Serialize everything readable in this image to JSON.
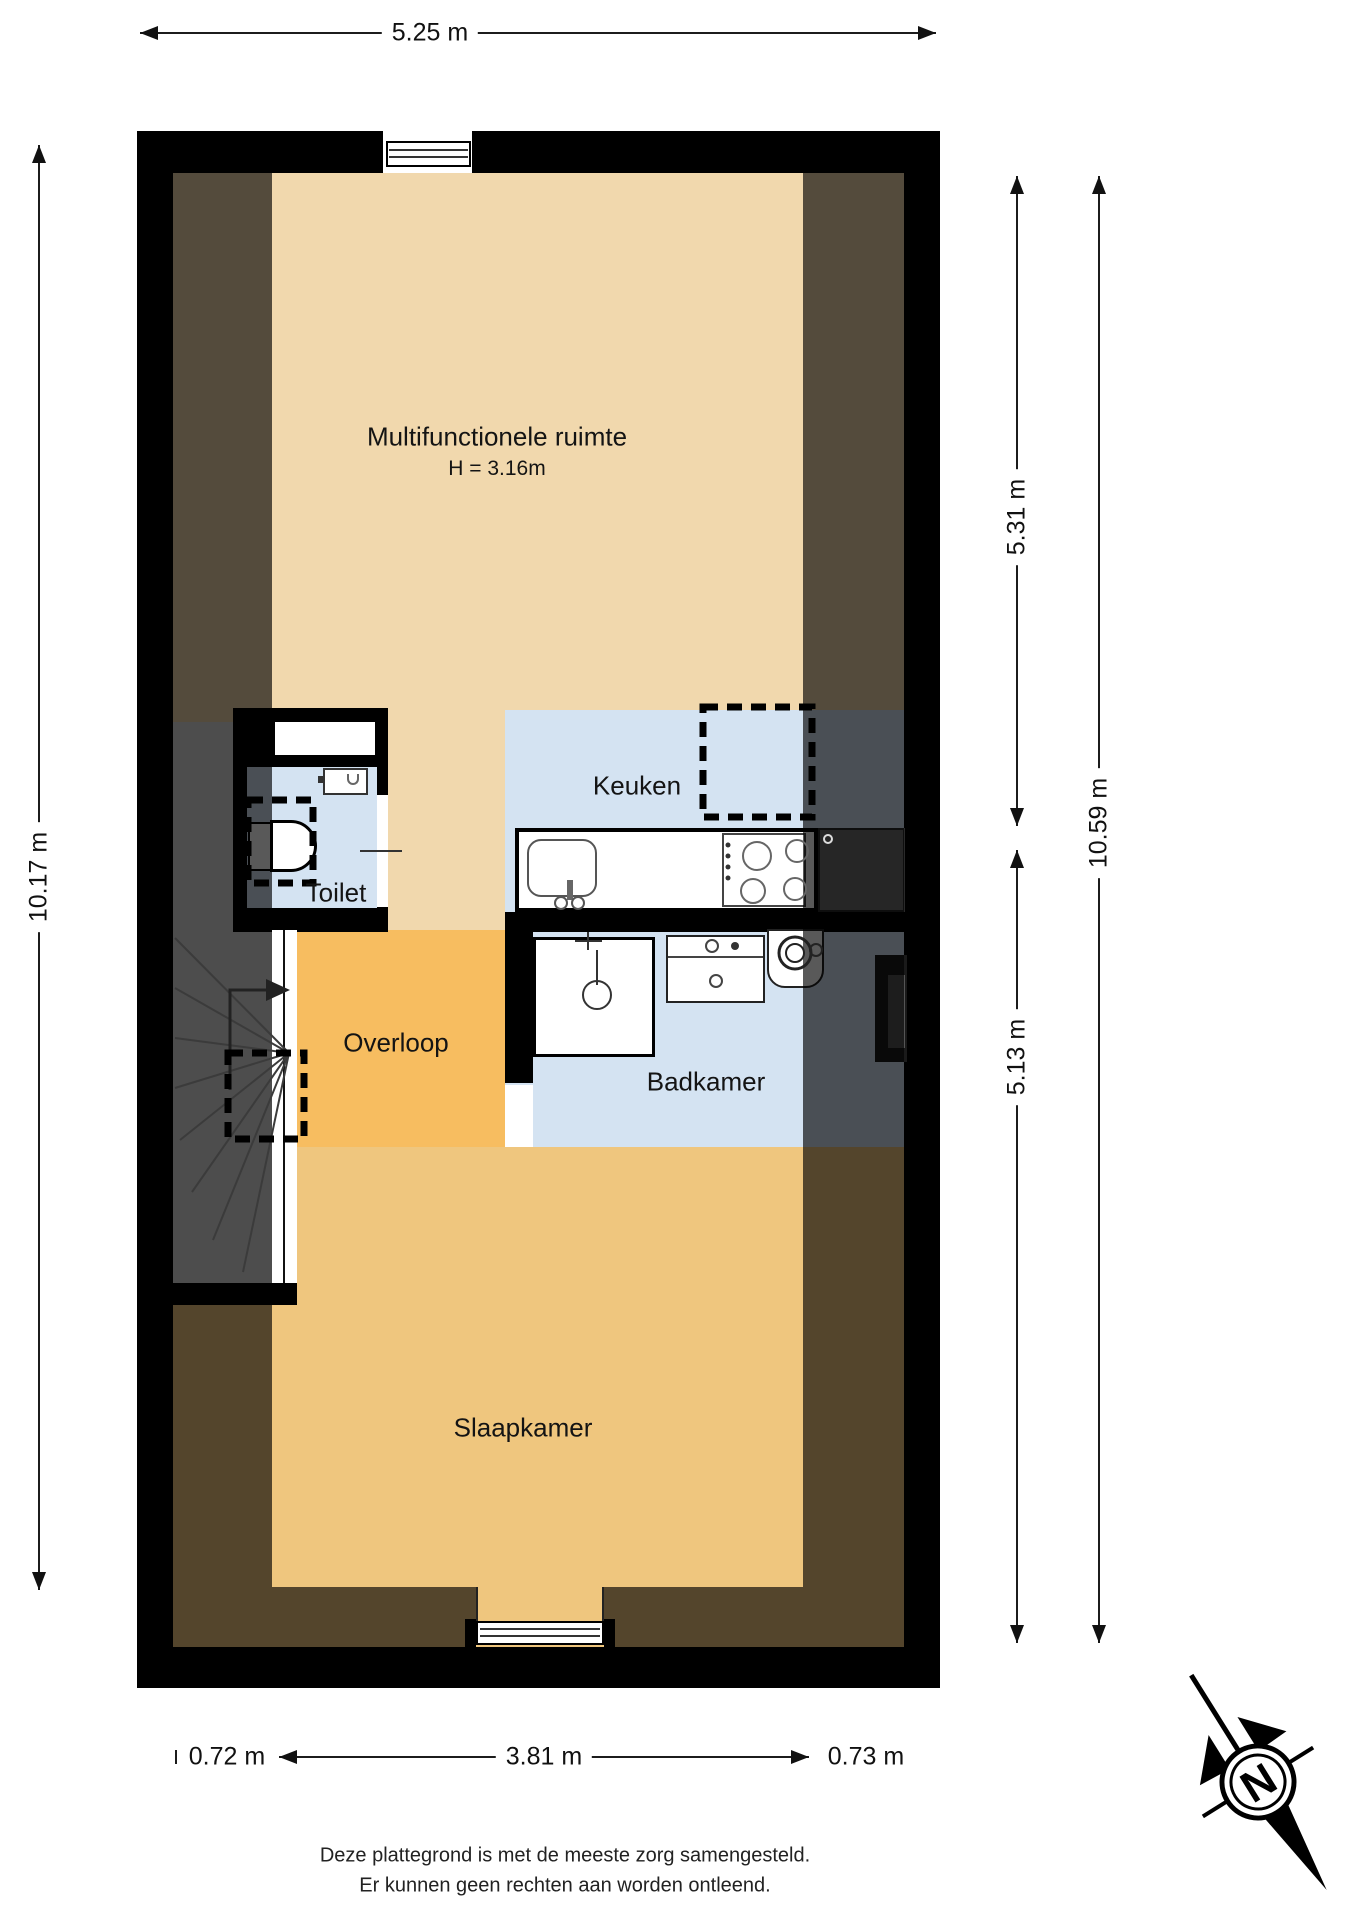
{
  "rooms": {
    "multifunctionele": {
      "label": "Multifunctionele ruimte",
      "height_note": "H = 3.16m"
    },
    "keuken": {
      "label": "Keuken"
    },
    "toilet": {
      "label": "Toilet"
    },
    "overloop": {
      "label": "Overloop"
    },
    "badkamer": {
      "label": "Badkamer"
    },
    "slaapkamer": {
      "label": "Slaapkamer"
    }
  },
  "dimensions": {
    "top_width": "5.25 m",
    "left_height": "10.17 m",
    "right_upper": "5.31 m",
    "right_total": "10.59 m",
    "right_lower": "5.13 m",
    "bottom_left": "0.72 m",
    "bottom_center": "3.81 m",
    "bottom_right": "0.73 m"
  },
  "compass": {
    "north_label": "N"
  },
  "footer": {
    "line1": "Deze plattegrond is met de meeste zorg samengesteld.",
    "line2": "Er kunnen geen rechten aan worden ontleend."
  },
  "colors": {
    "wall": "#000000",
    "floor_beige": "#f1d8ad",
    "floor_orange": "#f7bd60",
    "floor_orange_light": "#efc67e",
    "floor_blue": "#d4e3f2",
    "stairs_gray": "#dcdcdc",
    "roof_overlay": "rgba(0,0,0,0.65)"
  }
}
